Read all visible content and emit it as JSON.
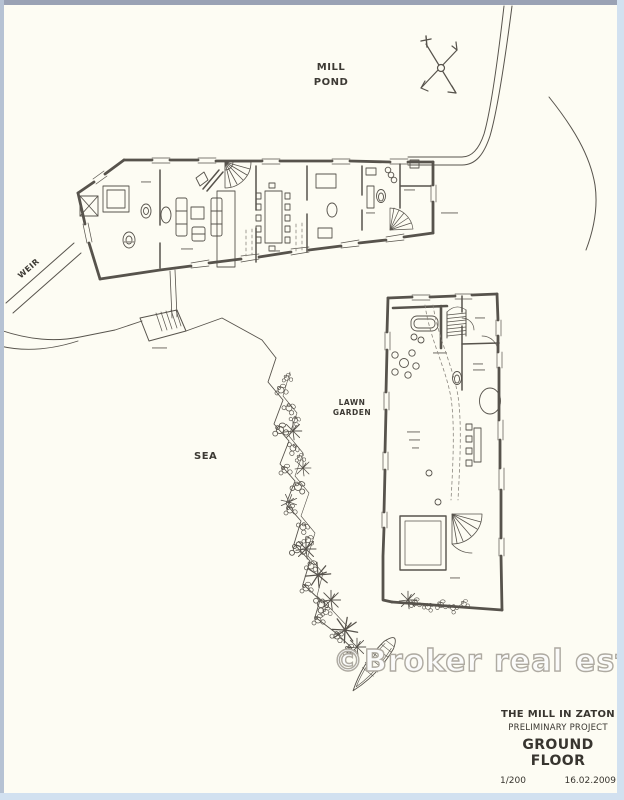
{
  "page": {
    "background": "#fdfcf3",
    "ink_color": "#57534c",
    "border_top_color": "#9aa2b4",
    "border_side_color": "#d2e1f0"
  },
  "labels": {
    "mill_pond_line1": "MILL",
    "mill_pond_line2": "POND",
    "weir": "WEIR",
    "sea": "SEA",
    "lawn_garden_line1": "LAWN",
    "lawn_garden_line2": "GARDEN"
  },
  "watermark": {
    "text": "©Broker real estate"
  },
  "title_block": {
    "project": "THE MILL IN ZATON",
    "phase": "PRELIMINARY PROJECT",
    "sheet": "GROUND FLOOR",
    "scale": "1/200",
    "date": "16.02.2009"
  },
  "drawing": {
    "kind": "site and ground floor plan, hand-drafted ink on cream paper",
    "icons": [
      "north-arrow"
    ]
  }
}
